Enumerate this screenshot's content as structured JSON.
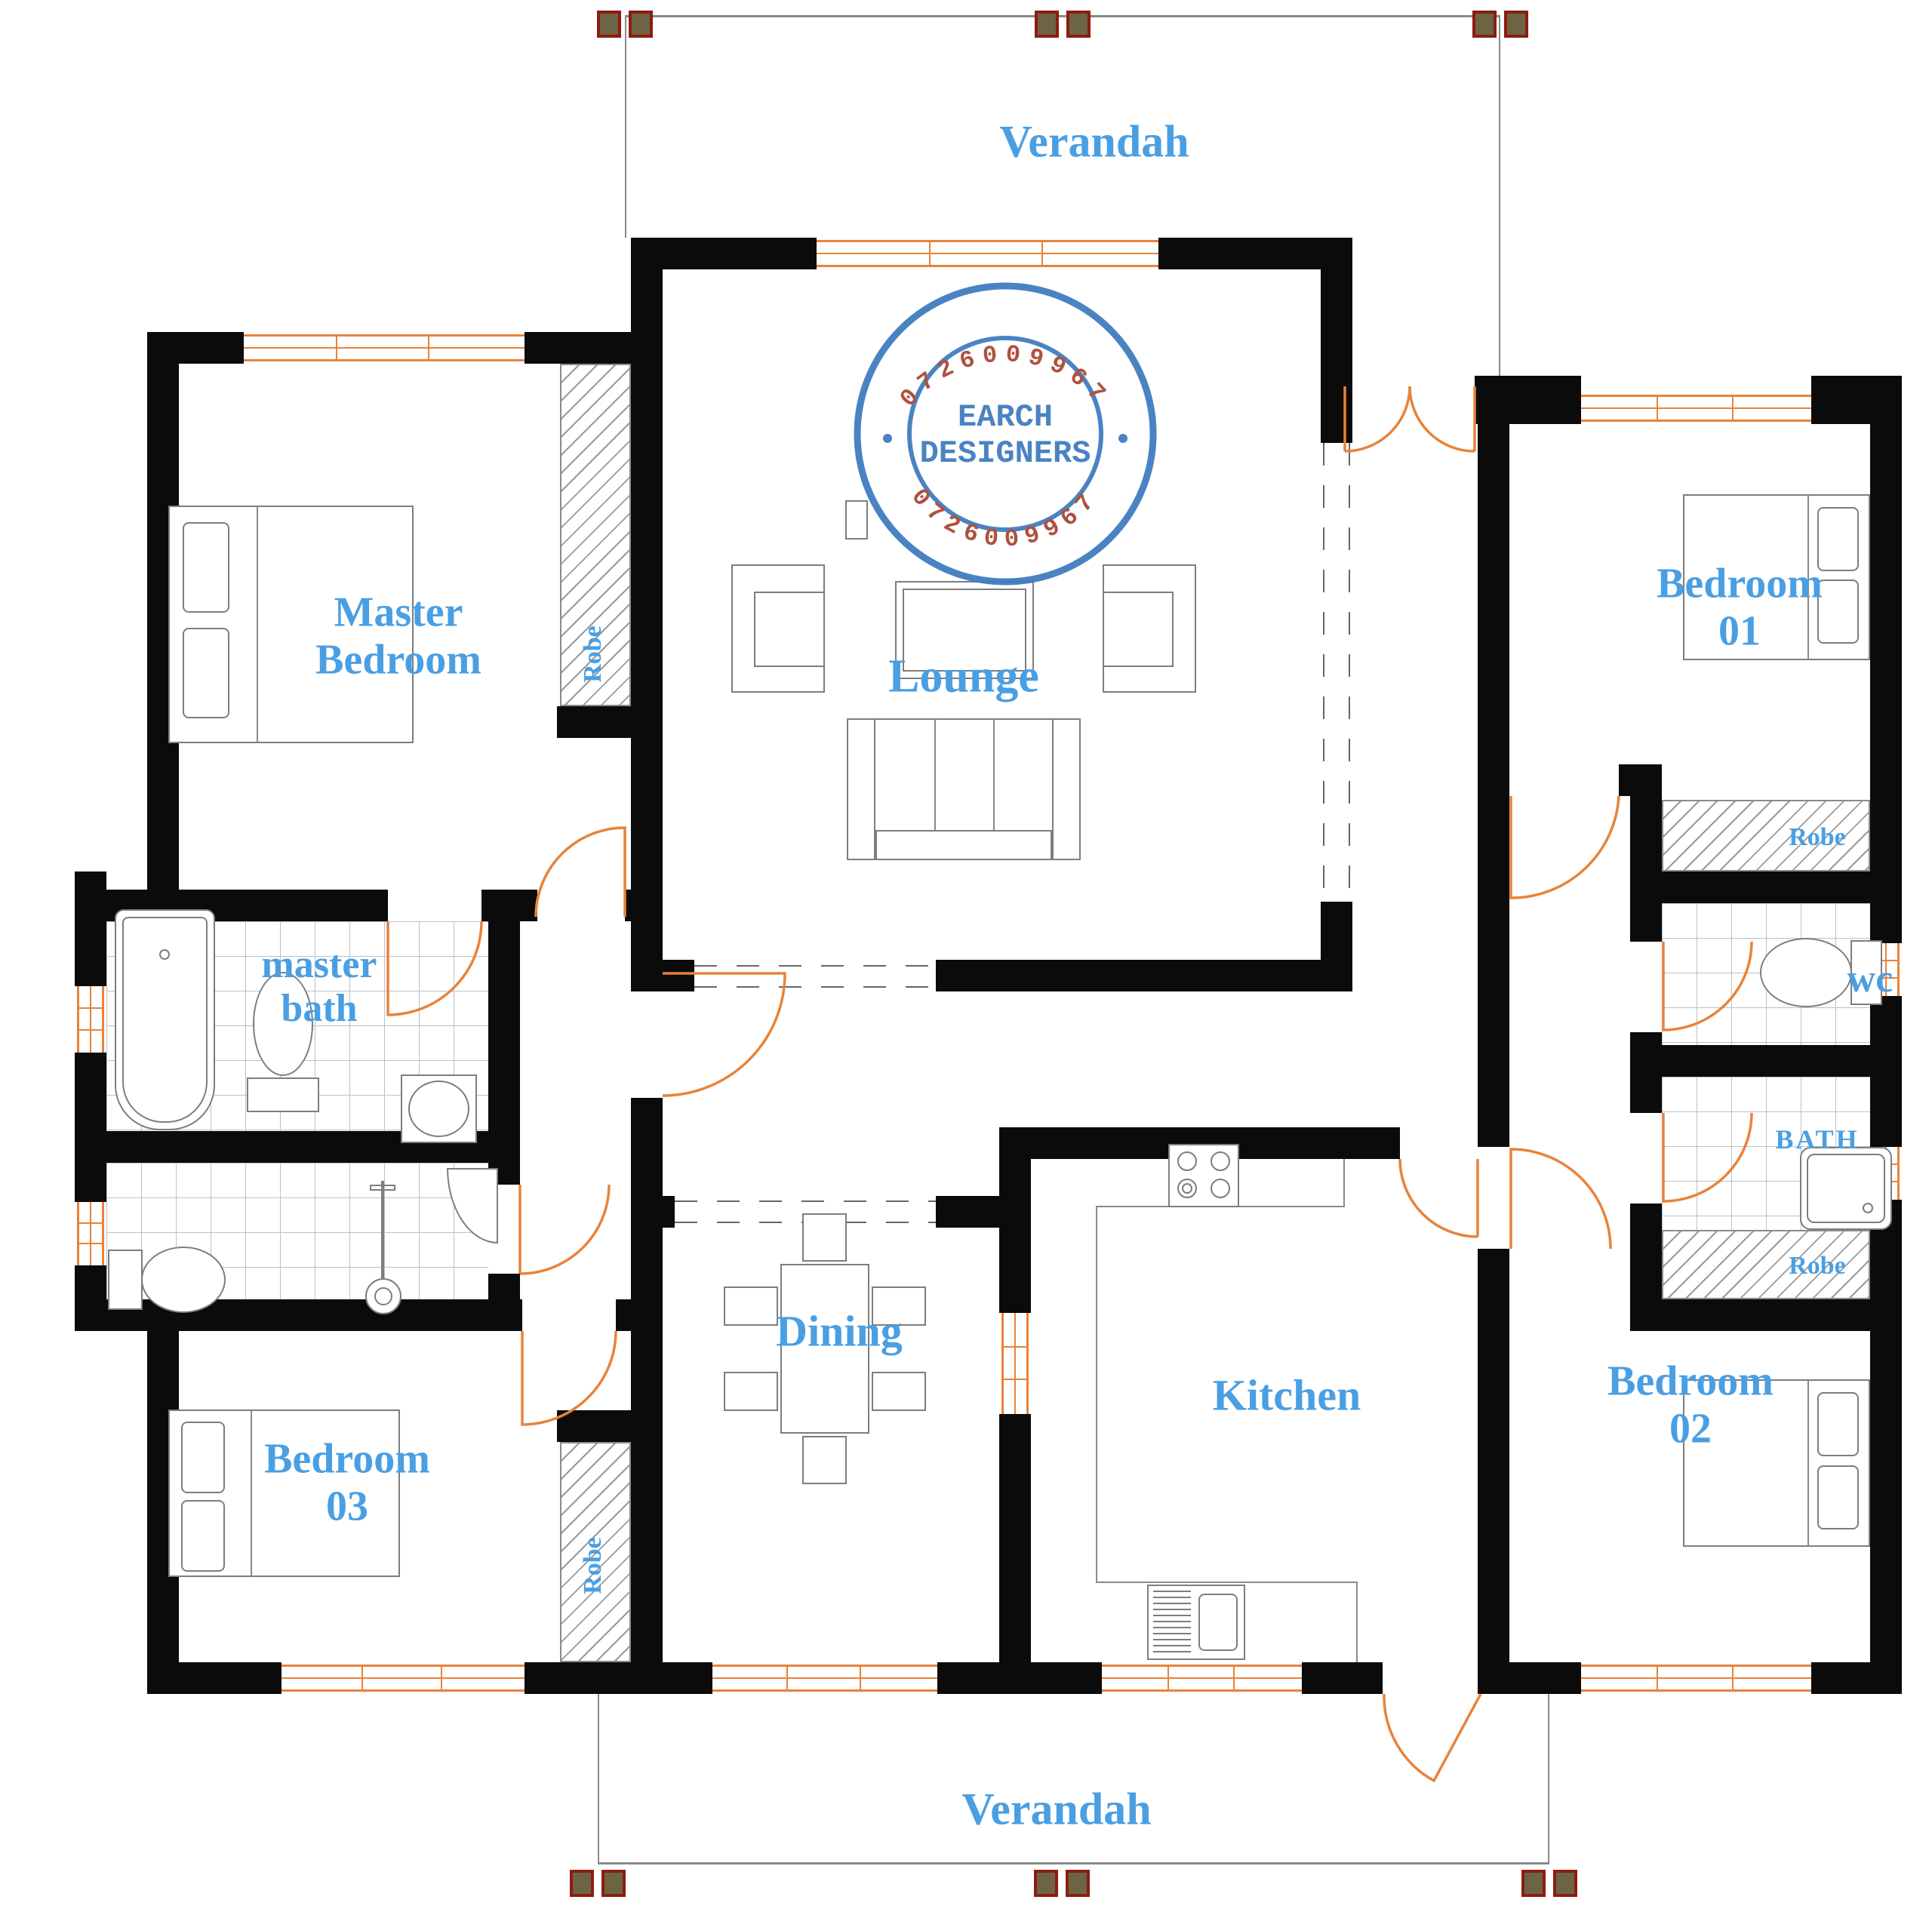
{
  "colors": {
    "wall": "#0b0b0b",
    "door_window_orange": "#e8833a",
    "label_blue": "#4a9fe3",
    "stamp_blue": "#3b79be",
    "stamp_red": "#a8432f",
    "column_fill": "#6d6444",
    "column_border": "#8e1c12",
    "tile_line": "#b7c2cb",
    "furniture_line": "#7d7d7d"
  },
  "stamp": {
    "name_line1": "EARCH",
    "name_line2": "DESIGNERS",
    "phone_top": "0726009967",
    "phone_bottom": "0726009967"
  },
  "rooms": {
    "verandah_top": "Verandah",
    "verandah_bottom": "Verandah",
    "master_bedroom": "Master\nBedroom",
    "lounge": "Lounge",
    "bedroom_01": "Bedroom\n01",
    "bedroom_02": "Bedroom\n02",
    "bedroom_03": "Bedroom\n03",
    "master_bath": "master\nbath",
    "dining": "Dining",
    "kitchen": "Kitchen",
    "wc": "wc",
    "bath": "BATH",
    "robe": "Robe"
  }
}
